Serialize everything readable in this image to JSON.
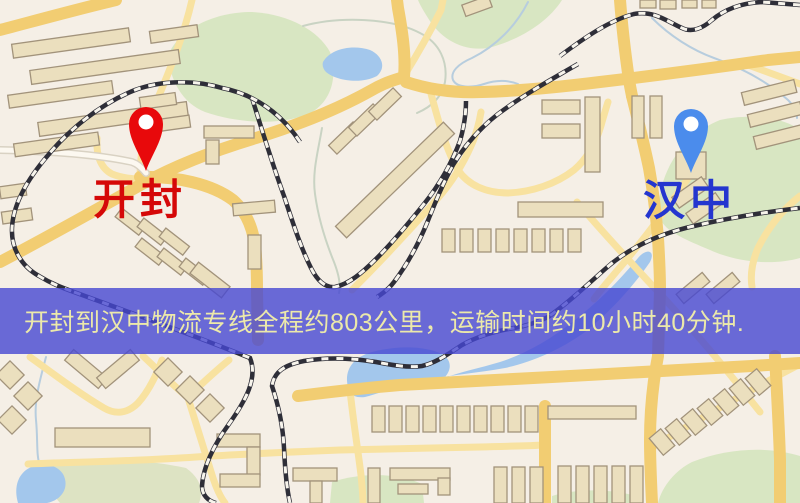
{
  "map": {
    "origin": {
      "label": "开封",
      "pin_color": "#e8090b",
      "label_color": "#d50808"
    },
    "destination": {
      "label": "汉中",
      "pin_color": "#4b8cec",
      "label_color": "#2436cf"
    },
    "banner": {
      "text": "开封到汉中物流专线全程约803公里，运输时间约10小时40分钟.",
      "origin_city": "开封",
      "destination_city": "汉中",
      "distance_km": "803",
      "duration_hours": "10",
      "duration_minutes": "40",
      "background_color": "rgba(70,71,210,0.80)",
      "text_color": "#ece9aa"
    },
    "palette": {
      "map_background": "#f5efe6",
      "road_major": "#f2cd72",
      "road_minor": "#f8e2a0",
      "water": "#a3c7ec",
      "park_green": "#d8e6c2",
      "building": "#ebdfbe",
      "railway": "#2e2e38"
    }
  }
}
